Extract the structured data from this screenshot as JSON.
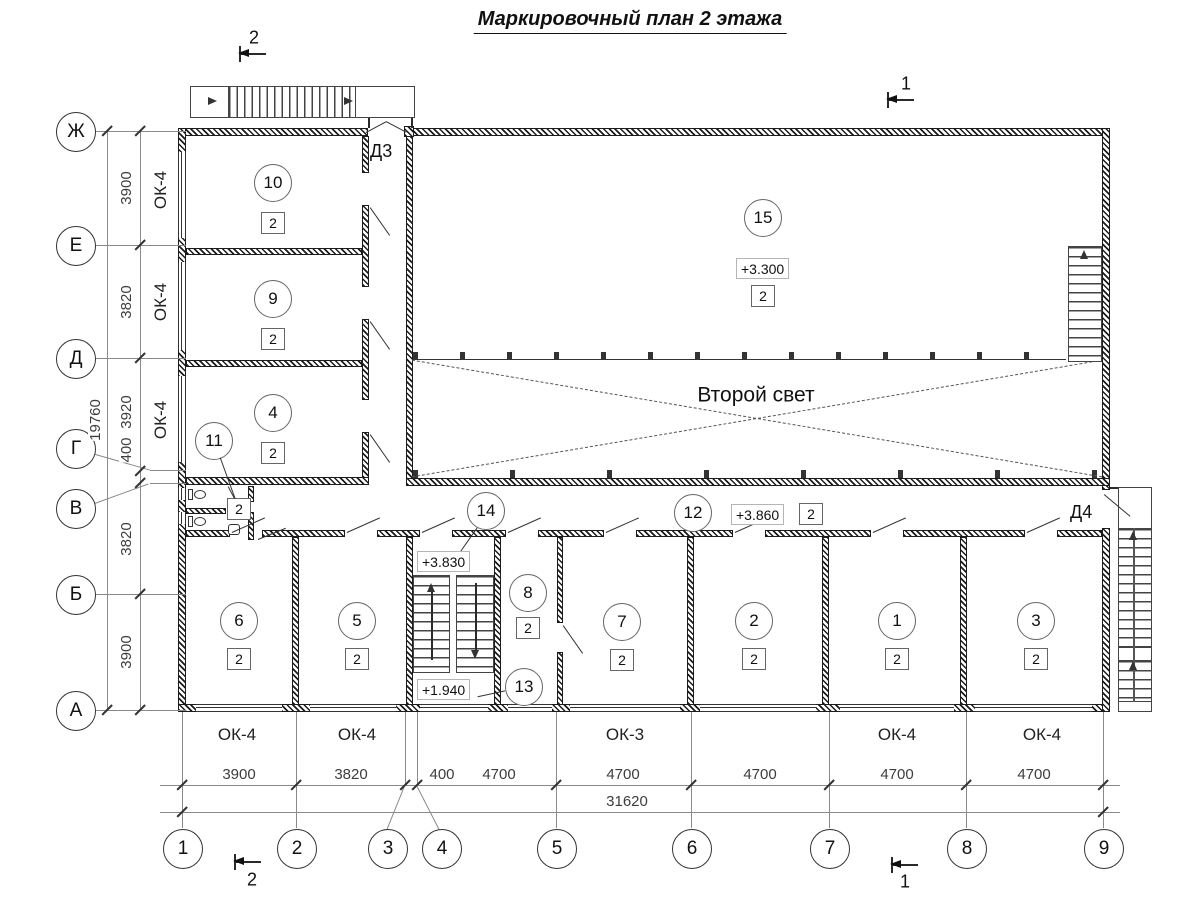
{
  "title": "Маркировочный план 2 этажа",
  "axes": {
    "left": [
      "Ж",
      "Е",
      "Д",
      "Г",
      "В",
      "Б",
      "А"
    ],
    "bottom": [
      "1",
      "2",
      "3",
      "4",
      "5",
      "6",
      "7",
      "8",
      "9"
    ]
  },
  "dims": {
    "left": [
      "3900",
      "3820",
      "3920",
      "400",
      "3820",
      "3900"
    ],
    "left_total": "19760",
    "bottom": [
      "3900",
      "3820",
      "400",
      "4700",
      "4700",
      "4700",
      "4700",
      "4700"
    ],
    "bottom_total": "31620"
  },
  "windows": {
    "left": [
      "ОК-4",
      "ОК-4",
      "ОК-4"
    ],
    "bottom": [
      "ОК-4",
      "ОК-4",
      "ОК-3",
      "ОК-4",
      "ОК-4"
    ]
  },
  "rooms": [
    {
      "number": "10",
      "unit": "2"
    },
    {
      "number": "9",
      "unit": "2"
    },
    {
      "number": "4",
      "unit": "2"
    },
    {
      "number": "11",
      "unit": "2"
    },
    {
      "number": "15",
      "unit": "2"
    },
    {
      "number": "14"
    },
    {
      "number": "12",
      "unit": "2"
    },
    {
      "number": "8",
      "unit": "2"
    },
    {
      "number": "13"
    },
    {
      "number": "7",
      "unit": "2"
    },
    {
      "number": "6",
      "unit": "2"
    },
    {
      "number": "5",
      "unit": "2"
    },
    {
      "number": "2",
      "unit": "2"
    },
    {
      "number": "1",
      "unit": "2"
    },
    {
      "number": "3",
      "unit": "2"
    }
  ],
  "elevations": {
    "hall": "+3.300",
    "corridor": "+3.860",
    "stair_upper": "+3.830",
    "stair_lower": "+1.940"
  },
  "doors": {
    "d3": "Д3",
    "d4": "Д4"
  },
  "labels": {
    "second_light": "Второй свет"
  },
  "sections": {
    "mark1": "1",
    "mark2": "2"
  }
}
